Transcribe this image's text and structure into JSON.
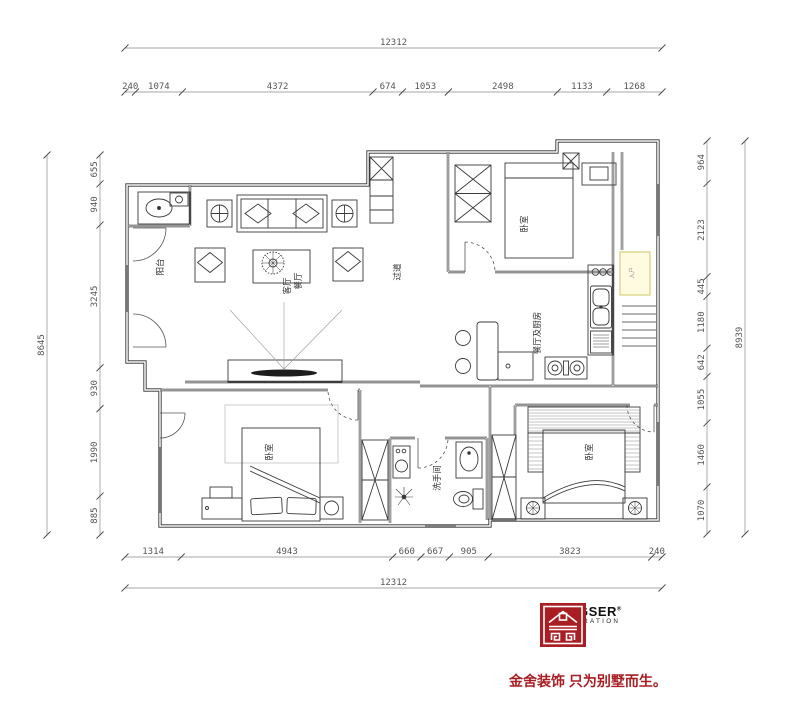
{
  "dimensions": {
    "top": {
      "overall": "12312",
      "segments": [
        "240",
        "1074",
        "4372",
        "674",
        "1053",
        "2498",
        "1133",
        "1268"
      ]
    },
    "bottom": {
      "overall": "12312",
      "segments": [
        "1314",
        "4943",
        "660",
        "667",
        "905",
        "3823",
        "240"
      ]
    },
    "left": {
      "overall": "8645",
      "segments": [
        "655",
        "940",
        "3245",
        "930",
        "1990",
        "885"
      ]
    },
    "right": {
      "overall": "8939",
      "segments": [
        "964",
        "2123",
        "445",
        "1180",
        "642",
        "1055",
        "1460",
        "1070"
      ]
    }
  },
  "rooms": {
    "balcony": "阳台",
    "living": "客厅",
    "dining": "餐厅",
    "hallway": "过道",
    "bedroom_top": "卧室",
    "kitchen_dining": "餐厅及厨房",
    "entry": "入户",
    "bedroom_left": "卧室",
    "bathroom": "洗手间",
    "bedroom_right": "卧室"
  },
  "logo": {
    "brand": "KINGSER",
    "reg": "®",
    "subtitle": "DECORATION",
    "slogan": "金舍装饰 只为别墅而生。",
    "red": "#a81e23"
  },
  "highlight": {
    "entry_box_color": "#fffbe0",
    "entry_box_border": "#d6cf7a"
  }
}
